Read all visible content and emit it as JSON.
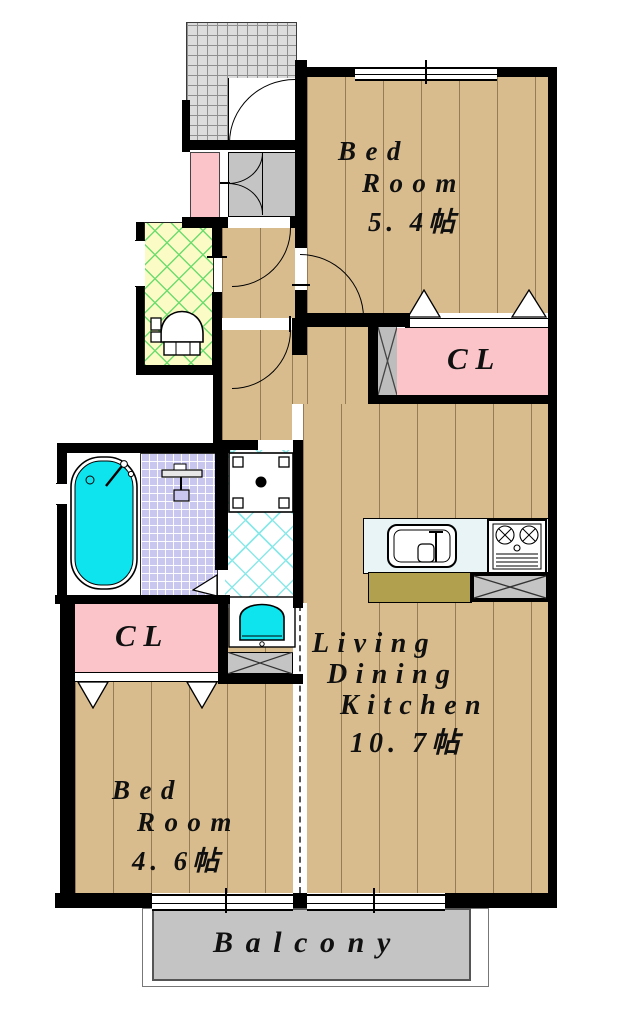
{
  "plan_title": "apartment-floor-plan",
  "rooms": {
    "bedroom_upper": {
      "name_line1": "Bed",
      "name_line2": "Room",
      "size": "5. 4帖"
    },
    "ldk": {
      "name_line1": "Living",
      "name_line2": "Dining",
      "name_line3": "Kitchen",
      "size": "10. 7帖"
    },
    "bedroom_lower": {
      "name_line1": "Bed",
      "name_line2": "Room",
      "size": "4. 6帖"
    },
    "closet_upper": {
      "label": "CL"
    },
    "closet_lower": {
      "label": "CL"
    },
    "balcony": {
      "label": "Balcony"
    }
  },
  "fixtures": [
    "entrance-genkan",
    "shoe-cabinet",
    "toilet",
    "bathtub",
    "bath-mixer",
    "washing-machine",
    "vanity-sink",
    "kitchen-sink",
    "gas-stove",
    "refrigerator-space",
    "laundry-pan",
    "pipe-pillar"
  ],
  "colors": {
    "wall": "#000000",
    "flooring": "#D8BC8E",
    "closet_pink": "#FAC4C8",
    "tub_cyan": "#0EE4EE",
    "toilet_floor_yellow": "#FBFBC6",
    "toilet_hatch_green": "#6FDC6F",
    "bath_tile_lavender": "#C9C6F0",
    "washroom_hatch_cyan": "#8BE8E8",
    "balcony_gray": "#C4C4C4",
    "kitchen_counter_olive": "#B1A04E",
    "kitchen_top_blue": "#E9F4F6",
    "genkan_gray": "#DCDCDC"
  }
}
